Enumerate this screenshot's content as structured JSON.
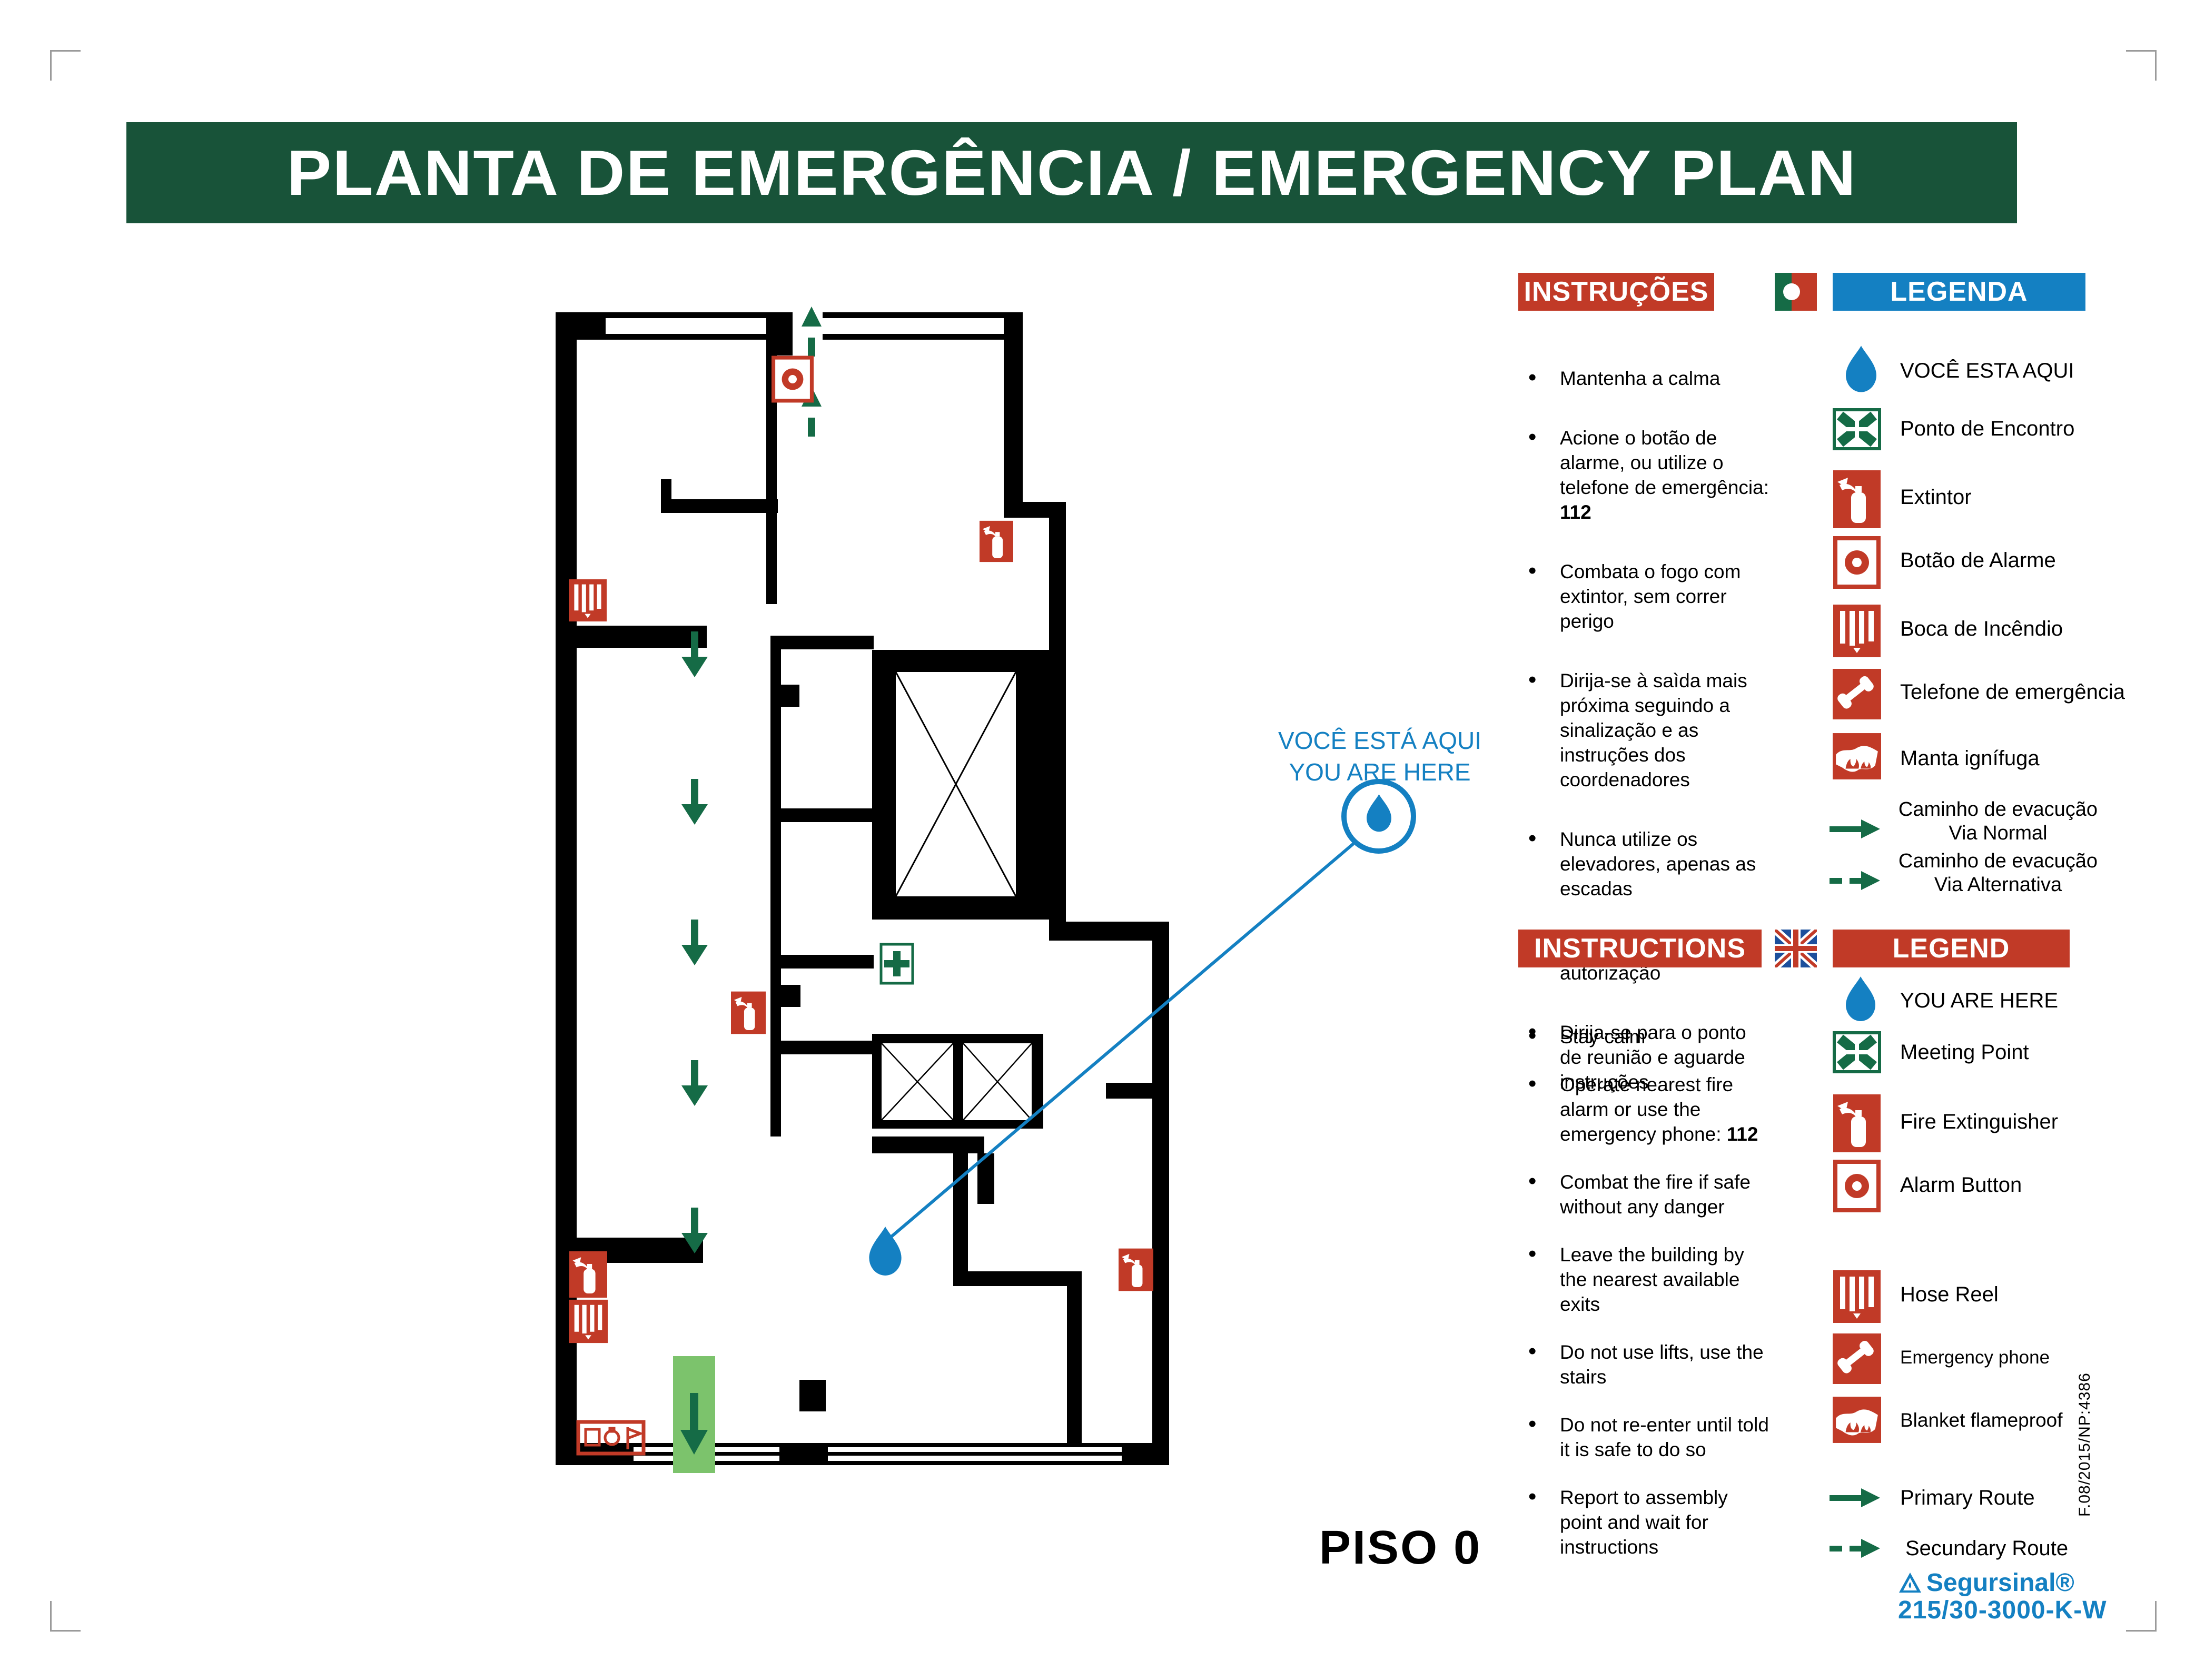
{
  "title": "PLANTA DE EMERGÊNCIA / EMERGENCY PLAN",
  "floor_label": "PISO 0",
  "map_marker": {
    "line1": "VOCÊ ESTÁ AQUI",
    "line2": "YOU ARE HERE"
  },
  "colors": {
    "banner_green": "#185339",
    "sign_red": "#c13a27",
    "legend_blue": "#1480c2",
    "route_green": "#156b46",
    "exit_light_green": "#7cc36c",
    "marker_blue": "#1480c2"
  },
  "panels": {
    "pt": {
      "instructions_header": "INSTRUÇÕES",
      "legend_header": "LEGENDA",
      "flag": "portugal-flag",
      "instructions": [
        {
          "pre": "Mantenha a calma",
          "bold": ""
        },
        {
          "pre": "Acione o botão de alarme, ou utilize o telefone de emergência: ",
          "bold": "112"
        },
        {
          "pre": "Combata o fogo com extintor, sem correr perigo",
          "bold": ""
        },
        {
          "pre": "Dirija-se à saìda mais próxima seguindo a sinalização e as instruções dos coordenadores",
          "bold": ""
        },
        {
          "pre": "Nunca utilize os elevadores, apenas as escadas",
          "bold": ""
        },
        {
          "pre": "Nunca volte atrás sem autorização",
          "bold": ""
        },
        {
          "pre": "Dirija-se para o ponto de reunião e aguarde instruções",
          "bold": ""
        }
      ],
      "legend": [
        "VOCÊ ESTA AQUI",
        "Ponto de Encontro",
        "Extintor",
        "Botão de Alarme",
        "Boca de Incêndio",
        "Telefone de emergência",
        "Manta ignífuga"
      ],
      "route_normal_1": "Caminho de evacução",
      "route_normal_2": "Via Normal",
      "route_alt_1": "Caminho de evacução",
      "route_alt_2": "Via Alternativa"
    },
    "en": {
      "instructions_header": "INSTRUCTIONS",
      "legend_header": "LEGEND",
      "flag": "uk-flag",
      "instructions": [
        {
          "pre": "Stay calm",
          "bold": ""
        },
        {
          "pre": "Operate nearest fire alarm or use the emergency phone: ",
          "bold": "112"
        },
        {
          "pre": "Combat the fire if safe without any danger",
          "bold": ""
        },
        {
          "pre": "Leave the building by the nearest available exits",
          "bold": ""
        },
        {
          "pre": "Do not use lifts, use the stairs",
          "bold": ""
        },
        {
          "pre": "Do not re-enter until told it is safe to do so",
          "bold": ""
        },
        {
          "pre": "Report to assembly point and wait for instructions",
          "bold": ""
        }
      ],
      "legend": [
        "YOU ARE HERE",
        "Meeting Point",
        "Fire Extinguisher",
        "Alarm Button",
        "Hose Reel",
        "Emergency phone",
        "Blanket flameproof"
      ],
      "route_primary": "Primary Route",
      "route_secondary": "Secundary Route"
    }
  },
  "footer": {
    "brand": "Segursinal®",
    "code": "215/30-3000-K-W",
    "doc_ref": "F.08/2015/NP:4386"
  }
}
